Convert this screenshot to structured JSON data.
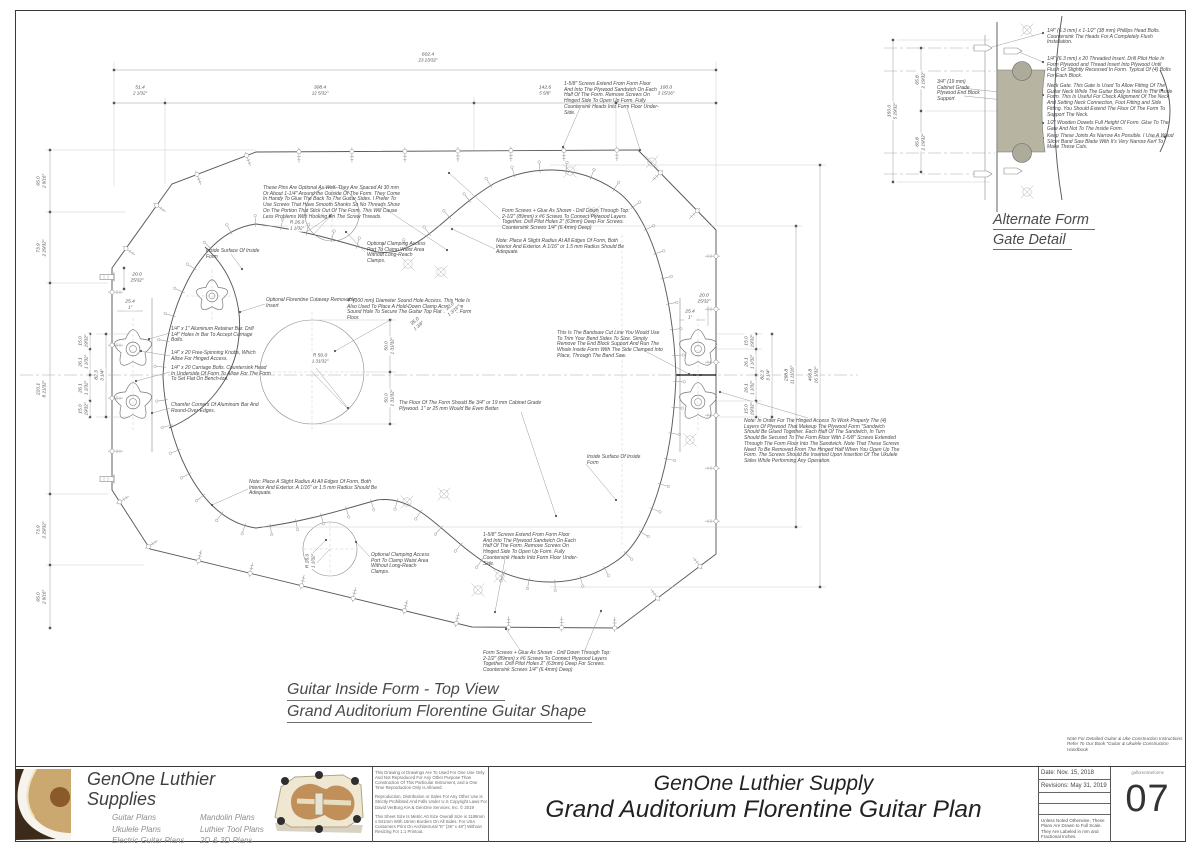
{
  "colors": {
    "gate_fill": "#b7b5a2",
    "plywood": "#efe7d2",
    "cork": "#c1905a",
    "line_gray": "#5a5a5a"
  },
  "captions": {
    "main": [
      "Guitar Inside Form - Top View",
      "Grand Auditorium Florentine Guitar Shape"
    ],
    "detail": [
      "Alternate Form",
      "Gate Detail"
    ]
  },
  "handbook_note": [
    "Note For Detailed Guitar & Uke Construction Instructions",
    "Refer To Our Book \"Guitar & Ukulele Construction",
    "Handbook"
  ],
  "main_drawing": {
    "annotations": [
      {
        "name": "pins-note",
        "x": 263,
        "y": 186,
        "lines": [
          "These Pins Are Optional As Well. They Are Spaced At 30 mm",
          "Or About 1-1/4\" Around the Outside Of The Form. They Come",
          "In Handy To Glue The Back To The Guitar Sides. I Prefer To",
          "Use Screws That Have Smooth Shanks So No Threads Show",
          "On The Portion That Stick Out Of The Form. This Will Cause",
          "Less Problems With Hooking On The Screw Threads."
        ]
      },
      {
        "name": "form-screws-note-top",
        "x": 502,
        "y": 209,
        "lines": [
          "Form Screws + Glue As Shown - Drill Down Through Top:",
          "2-1/2\" (89mm) x #6 Screws To Connect Plywood Layers",
          "Together. Drill Pilot Holes 2\" (63mm) Deep For Screws.",
          "Countersink Screws 1/4\" (6.4mm) Deep)"
        ]
      },
      {
        "name": "radius-note-top",
        "x": 496,
        "y": 239,
        "lines": [
          "Note: Place A Slight Radius At All Edges Of Form, Both",
          "Interior And Exterior. A 1/16\" or 1.5 mm Radius Should Be",
          "Adequate."
        ]
      },
      {
        "name": "clamp-port-note-top",
        "x": 367,
        "y": 242,
        "lines": [
          "Optional Clamping Access",
          "Port To Clamp Waist Area",
          "Without Long-Reach",
          "Clamps."
        ]
      },
      {
        "name": "inside-surface-note-left",
        "x": 206,
        "y": 249,
        "lines": [
          "Inside Surface Of Inside",
          "Form"
        ]
      },
      {
        "name": "florentine-insert-note",
        "x": 266,
        "y": 298,
        "lines": [
          "Optional Florentine Cutaway Removable",
          "Insert"
        ]
      },
      {
        "name": "soundhole-note",
        "x": 347,
        "y": 299,
        "lines": [
          "4\" (100 mm) Diameter Sound Hole Access. This Hole Is",
          "Also Used To Place A Hold-Down Clamp Across The",
          "Sound Hole To Secure The Guitar Top Flat To The Form",
          "Floor."
        ]
      },
      {
        "name": "aluminum-bar-note",
        "x": 171,
        "y": 327,
        "lines": [
          "1/4\" x 1\" Aluminum Retainer Bar. Drill",
          "1/4\" Holes In Bar To Accept Carriage",
          "Bolts."
        ]
      },
      {
        "name": "knobs-note",
        "x": 171,
        "y": 351,
        "lines": [
          "1/4\" x 20 Free-Spinning Knobs, Which",
          "Allow For Hinged Access."
        ]
      },
      {
        "name": "carriage-bolts-note",
        "x": 171,
        "y": 366,
        "lines": [
          "1/4\" x 20 Carriage Bolts. Countersink Head",
          "In Underside Of Form To Allow For The Form",
          "To Set Flat On Bench-top."
        ]
      },
      {
        "name": "chamfer-note",
        "x": 171,
        "y": 403,
        "lines": [
          "Chamfer Corners Of Aluminum Bar And",
          "Round-Over Edges."
        ]
      },
      {
        "name": "bandsaw-note",
        "x": 557,
        "y": 331,
        "lines": [
          "This Is The Bandsaw Cut Line You Would Use",
          "To Trim Your Bend Sides To Size. Simply",
          "Remove The End Block Support And Run The",
          "Whole Inside Form With The Side Clamped Into",
          "Place, Through The Band Saw."
        ]
      },
      {
        "name": "floor-note",
        "x": 399,
        "y": 401,
        "lines": [
          "The Floor Of The Form Should Be 3/4\" or 19 mm Cabinet Grade",
          "Plywood. 1\" or 25 mm Would Be Even Better."
        ]
      },
      {
        "name": "hinged-access-note",
        "x": 744,
        "y": 419,
        "lines": [
          "Note: In Order For The Hinged Access To Work Properly The (4)",
          "Layers Of Plywood That Makeup The Plywood Form \"Sandwich",
          "Should Be Glued Together. Each Half Of The Sandwich, In Turn",
          "Should Be Secured To The Form Floor With 1-5/8\" Screws Extended",
          "Through The Form Floor Into The Sandwich. Note That These Screws",
          "Need To Be Removed From The Hinged Half When You Open Up The",
          "Form. The Screws Should Be Inserted Upon Insertion Of The Ukulele",
          "Sides While Performing Any Operation."
        ]
      },
      {
        "name": "inside-surface-note-right",
        "x": 587,
        "y": 455,
        "lines": [
          "Inside Surface Of Inside",
          "Form"
        ]
      },
      {
        "name": "screws-note-top",
        "x": 564,
        "y": 82,
        "lines": [
          "1-5/8\" Screws Extend From Form Floor",
          "And Into The Plywood Sandwich On Each",
          "Half Of The Form. Remove Screws On",
          "Hinged Side To Open Up Form. Fully",
          "Countersink Heads Into Form Floor Under-",
          "Side."
        ]
      },
      {
        "name": "screws-note-bottom",
        "x": 483,
        "y": 533,
        "lines": [
          "1-5/8\" Screws Extend From Form Floor",
          "And Into The Plywood Sandwich On Each",
          "Half Of The Form. Remove Screws On",
          "Hinged Side To Open Up Form. Fully",
          "Countersink Heads Into Form Floor Under-",
          "Side."
        ]
      },
      {
        "name": "radius-note-bottom",
        "x": 249,
        "y": 480,
        "lines": [
          "Note: Place A Slight Radius At All Edges Of Form, Both",
          "Interior And Exterior. A 1/16\" or 1.5 mm Radius Should Be",
          "Adequate."
        ]
      },
      {
        "name": "clamp-port-note-bottom",
        "x": 371,
        "y": 553,
        "lines": [
          "Optional Clamping Access",
          "Port To Clamp Waist Area",
          "Without Long-Reach",
          "Clamps."
        ]
      },
      {
        "name": "form-screws-note-bottom",
        "x": 483,
        "y": 651,
        "lines": [
          "Form Screws + Glue As Shown - Drill Down Through Top:",
          "2-1/2\" (89mm) x #6 Screws To Connect Plywood Layers",
          "Together. Drill Pilot Holes 2\" (63mm) Deep For Screws.",
          "Countersink Screws 1/4\" (6.4mm) Deep)"
        ]
      }
    ],
    "dimensions": [
      {
        "x": 428,
        "y": 58,
        "rot": 0,
        "mm": "602.4",
        "in": "23 23/32\""
      },
      {
        "x": 140,
        "y": 91,
        "rot": 0,
        "mm": "51.4",
        "in": "2 1/32\""
      },
      {
        "x": 320,
        "y": 91,
        "rot": 0,
        "mm": "308.4",
        "in": "12 5/32\""
      },
      {
        "x": 545,
        "y": 91,
        "rot": 0,
        "mm": "142.6",
        "in": "5 5/8\""
      },
      {
        "x": 666,
        "y": 91,
        "rot": 0,
        "mm": "100.0",
        "in": "3 15/16\""
      },
      {
        "x": 42,
        "y": 181,
        "rot": -90,
        "mm": "65.0",
        "in": "2 9/16\""
      },
      {
        "x": 42,
        "y": 248,
        "rot": -90,
        "mm": "73.9",
        "in": "2 29/32\""
      },
      {
        "x": 42,
        "y": 389,
        "rot": -90,
        "mm": "220.1",
        "in": "8 21/32\""
      },
      {
        "x": 42,
        "y": 530,
        "rot": -90,
        "mm": "73.9",
        "in": "2 29/32\""
      },
      {
        "x": 42,
        "y": 597,
        "rot": -90,
        "mm": "65.0",
        "in": "2 9/16\""
      },
      {
        "x": 84,
        "y": 341,
        "rot": -90,
        "mm": "15.0",
        "in": "19/32\""
      },
      {
        "x": 84,
        "y": 362,
        "rot": -90,
        "mm": "26.1",
        "in": "1 1/32\""
      },
      {
        "x": 84,
        "y": 388,
        "rot": -90,
        "mm": "26.1",
        "in": "1 1/32\""
      },
      {
        "x": 84,
        "y": 409,
        "rot": -90,
        "mm": "15.0",
        "in": "19/32\""
      },
      {
        "x": 100,
        "y": 375,
        "rot": -90,
        "mm": "82.3",
        "in": "3 1/4\""
      },
      {
        "x": 750,
        "y": 341,
        "rot": -90,
        "mm": "15.0",
        "in": "19/32\""
      },
      {
        "x": 750,
        "y": 362,
        "rot": -90,
        "mm": "26.1",
        "in": "1 1/32\""
      },
      {
        "x": 750,
        "y": 388,
        "rot": -90,
        "mm": "26.1",
        "in": "1 1/32\""
      },
      {
        "x": 750,
        "y": 409,
        "rot": -90,
        "mm": "15.0",
        "in": "19/32\""
      },
      {
        "x": 766,
        "y": 375,
        "rot": -90,
        "mm": "82.3",
        "in": "3 1/4\""
      },
      {
        "x": 790,
        "y": 375,
        "rot": -90,
        "mm": "298.8",
        "in": "11 11/16\""
      },
      {
        "x": 814,
        "y": 375,
        "rot": -90,
        "mm": "406.8",
        "in": "16 1/32\""
      },
      {
        "x": 390,
        "y": 346,
        "rot": -90,
        "mm": "50.0",
        "in": "1 31/32\""
      },
      {
        "x": 390,
        "y": 398,
        "rot": -90,
        "mm": "50.0",
        "in": "1 31/32\""
      },
      {
        "x": 137,
        "y": 278,
        "rot": 0,
        "mm": "20.0",
        "in": "25/32\""
      },
      {
        "x": 130,
        "y": 305,
        "rot": 0,
        "mm": "25.4",
        "in": "1\""
      },
      {
        "x": 704,
        "y": 299,
        "rot": 0,
        "mm": "20.0",
        "in": "25/32\""
      },
      {
        "x": 690,
        "y": 315,
        "rot": 0,
        "mm": "25.4",
        "in": "1\""
      },
      {
        "x": 452,
        "y": 309,
        "rot": -40,
        "mm": "30.0",
        "in": "1 3/16\""
      },
      {
        "x": 417,
        "y": 324,
        "rot": -40,
        "mm": "35.0",
        "in": "1 3/8\""
      },
      {
        "x": 297,
        "y": 226,
        "rot": 0,
        "mm": "R 26.0",
        "in": "1 1/32\""
      },
      {
        "x": 320,
        "y": 359,
        "rot": 0,
        "mm": "R 50.0",
        "in": "1 31/32\""
      },
      {
        "x": 311,
        "y": 561,
        "rot": -90,
        "mm": "R 26.0",
        "in": "1 1/32\""
      }
    ]
  },
  "detail_drawing": {
    "annotations": [
      {
        "name": "bolt-note",
        "x": 1047,
        "y": 29,
        "lines": [
          "1/4\" (6.3 mm)  x 1-1/2\" (38 mm) Phillips Head Bolts.",
          "Countersink The Heads For A Completely Flush",
          "Installation."
        ]
      },
      {
        "name": "threaded-insert-note",
        "x": 1047,
        "y": 57,
        "lines": [
          "1/4\" (6.3 mm) x 20 Threaded Insert. Drill Pilot Hole In",
          "Form Plywood and Thread Insert Into Plywood Until",
          "Flush Or Slightly Recessed In Form. Typical Of (4) Bolts",
          "For Each Block."
        ]
      },
      {
        "name": "neck-gate-note",
        "x": 1047,
        "y": 84,
        "lines": [
          "Neck Gate. This Gate Is Used To Allow Fitting Of The",
          "Guitar Neck While The Guitar Body Is Held In The Inside",
          "Form. This Is Useful For Check Alignment Of The Neck",
          "And Setting Neck Connection, Foot Fitting and Side",
          "Fitting. You Should Extend The Floor Of The Form To",
          "Support The Neck."
        ]
      },
      {
        "name": "dowel-note",
        "x": 1047,
        "y": 121,
        "lines": [
          "1/2\" Wooden Dowels Full Height Of Form. Glue To The",
          "Gate And Not To The Inside Form."
        ]
      },
      {
        "name": "kerf-note",
        "x": 1047,
        "y": 134,
        "lines": [
          "Keep These Joints As Narrow As Possible. I Use A Wood",
          "Slicer Band Saw Blade With It's Very Narrow Kerf To",
          "Make These Cuts."
        ]
      },
      {
        "name": "end-block-note",
        "x": 937,
        "y": 80,
        "lines": [
          "3/4\" (19 mm)",
          "Cabinet Grade",
          "Plywood End Block",
          "Support"
        ]
      }
    ],
    "dimensions": [
      {
        "x": 893,
        "y": 111,
        "rot": -90,
        "mm": "150.0",
        "in": "5 29/32\""
      },
      {
        "x": 921,
        "y": 80,
        "rot": -90,
        "mm": "65.8",
        "in": "2 19/32\""
      },
      {
        "x": 921,
        "y": 142,
        "rot": -90,
        "mm": "65.8",
        "in": "2 19/32\""
      }
    ]
  },
  "title_block": {
    "brand": "GenOne Luthier Supplies",
    "plans_col1": [
      "Guitar Plans",
      "Ukulele Plans",
      "Electric Guitar Plans"
    ],
    "plans_col2": [
      "Mandolin Plans",
      "Luthier Tool Plans",
      "2D & 3D Plans"
    ],
    "copyright": [
      "This Drawing or Drawings Are To Used For One Use Only And Not Reproduced For Any Other Purpose Than Construction Of This Particular Instrument, and a One Time Reproduction Only is Allowed",
      "Reproduction, Distribution or Sales For Any Other Use Is Strictly Prohibited And Falls Under U.S Copyright Laws For David VerBurg AIA & GenOne Services, Inc. © 2019",
      "This Sheet Size Is Metric A0 Size Overall Size is 1189mm x 841mm With 15mm Borders On All Sides. For USA Customers Print On Architectural \"E\" (36\" x 48\") Without Resizing For 1:1 Printout."
    ],
    "title_sub": "GenOne Luthier Supply",
    "title_main": "Grand Auditorium Florentine Guitar Plan",
    "date": "Date: Nov. 15, 2018",
    "revisions": "Revisions: May 31, 2019",
    "scale_note": "Unless Noted Otherwise, These Plans Are Drawn to Full Scale. They Are Labeled in mm and Fractional Inches.",
    "sheet_code": "gaflorentineforms",
    "sheet_number": "07"
  }
}
